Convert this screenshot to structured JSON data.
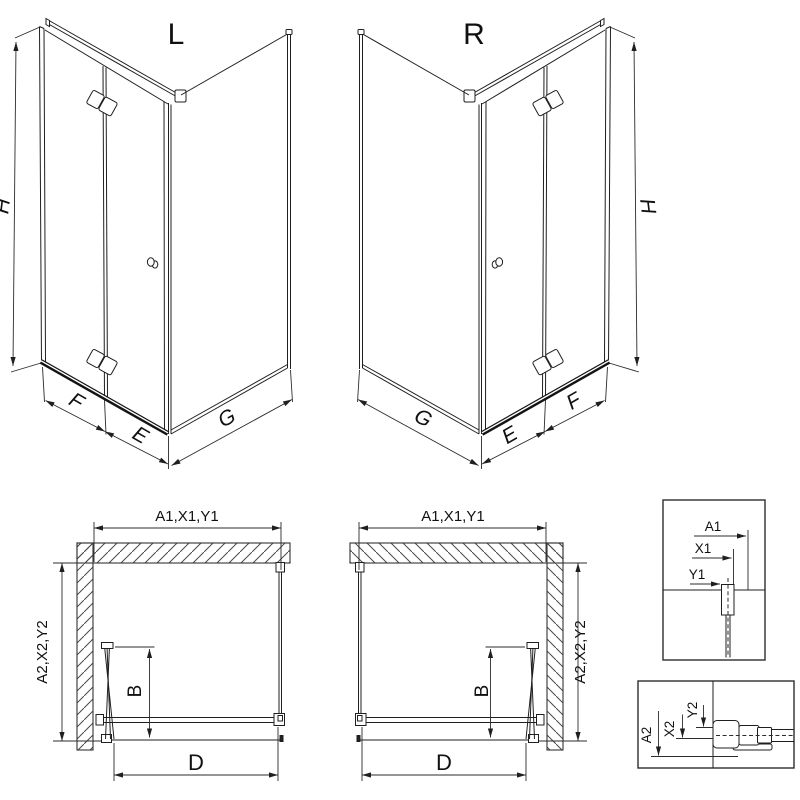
{
  "views": {
    "iso_left": {
      "title": "L",
      "dims": {
        "h": "H",
        "f": "F",
        "e": "E",
        "g": "G"
      }
    },
    "iso_right": {
      "title": "R",
      "dims": {
        "h": "H",
        "f": "F",
        "e": "E",
        "g": "G"
      }
    },
    "plan_left": {
      "dims": {
        "front_width": "A1,X1,Y1",
        "side_depth": "A2,X2,Y2",
        "door_fold": "B",
        "entry_width": "D"
      }
    },
    "plan_right": {
      "dims": {
        "front_width": "A1,X1,Y1",
        "side_depth": "A2,X2,Y2",
        "door_fold": "B",
        "entry_width": "D"
      }
    },
    "detail_width_profile": {
      "labels": {
        "a": "A1",
        "x": "X1",
        "y": "Y1"
      }
    },
    "detail_depth_profile": {
      "labels": {
        "a": "A2",
        "x": "X2",
        "y": "Y2"
      }
    }
  },
  "colors": {
    "line": "#1f1f1f",
    "background": "#ffffff"
  }
}
